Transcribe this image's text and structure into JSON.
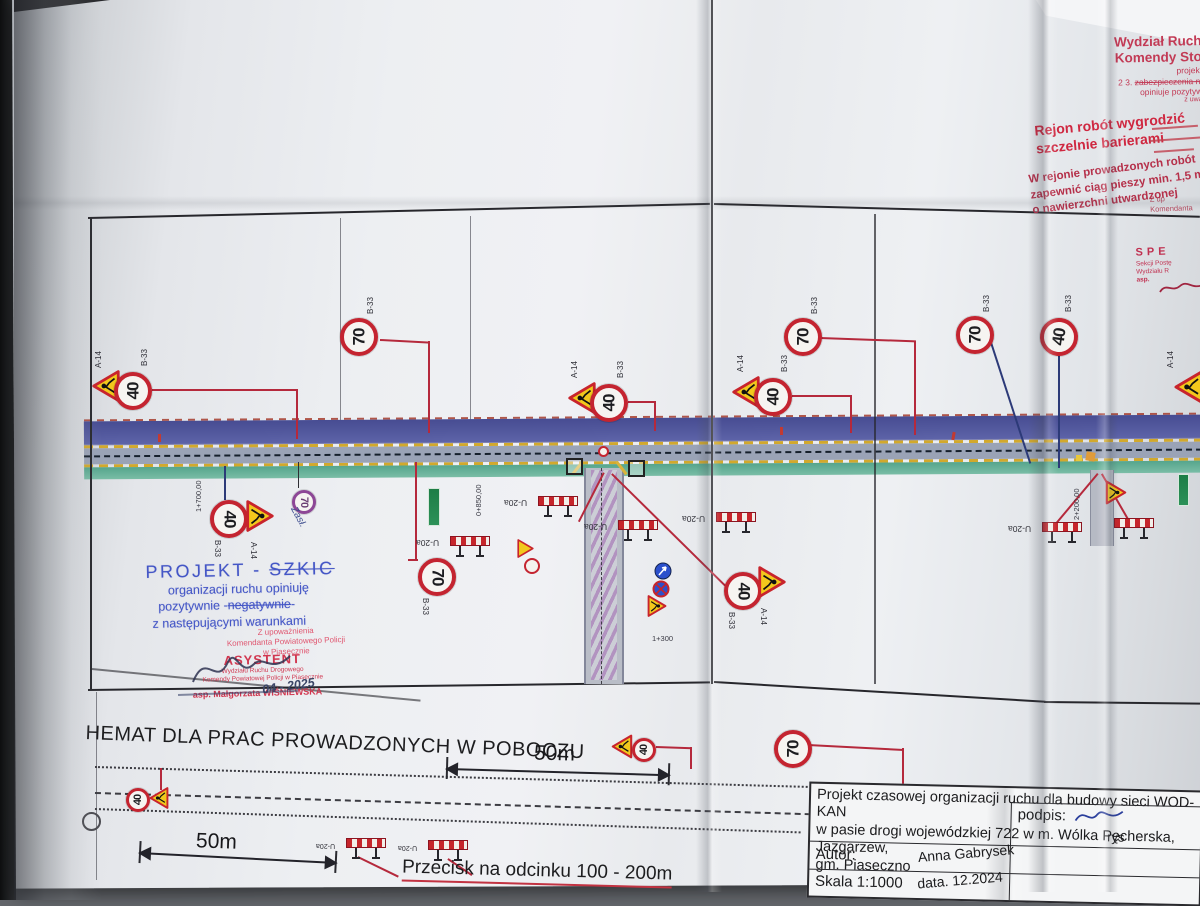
{
  "colors": {
    "paper": "#edeff2",
    "surface": "#63666b",
    "sign_red": "#c42430",
    "stamp_red": "#d1364f",
    "stamp_blue": "#4456c6",
    "road_blue": "#4d5296",
    "road_green": "#55a58c",
    "barrier_red": "#c6252b",
    "accent_yellow": "#f2c81c"
  },
  "plan": {
    "sign40": "40",
    "sign70": "70",
    "label_b33": "B-33",
    "label_a14": "A-14",
    "label_u20a": "U-20a",
    "hand_zasl": "Zasł.",
    "chainage_1": "1+700,00",
    "chainage_2": "0+850,00",
    "chainage_3": "2+200,00",
    "chainage_4": "1+300"
  },
  "stamps": {
    "wydzial": {
      "l1": "Wydział Ruch",
      "l2": "Komendy Sto",
      "l3": "projekt",
      "l4_prefix": "2 3. ",
      "l4_struck": "zabezpieczenia ni",
      "l5": "opiniuje pozytyw",
      "l6": "z uwa"
    },
    "fence_l1": "Rejon robót wygrodzić",
    "fence_l2": "szczelnie barierami",
    "walkway_l1": "W rejonie prowadzonych robót",
    "walkway_l2": "zapewnić ciąg pieszy min. 1,5 m",
    "walkway_l3": "o nawierzchni utwardzonej",
    "zup_l1": "Z up",
    "zup_l2": "Komendanta",
    "spe_l1": "SPE",
    "spe_l2": "Sekcji Postę",
    "spe_l3": "Wydziału R",
    "spe_l4": "asp.",
    "projekt": {
      "t1": "PROJEKT - ",
      "t1_struck": "SZKIC",
      "t2": "organizacji ruchu opiniuję",
      "t3a": "pozytywnie ",
      "t3b": "negatywnie",
      "t4": "z następującymi warunkami"
    },
    "upow_l1": "Z upoważnienia",
    "upow_l2": "Komendanta Powiatowego Policji",
    "upow_l3": "w Piasecznie",
    "asystent_l1": "ASYSTENT",
    "asystent_l2": "Wydziału Ruchu Drogowego",
    "asystent_l3": "Komendy Powiatowej Policji w Piasecznie",
    "officer": "asp. Małgorzata WIŚNIEWSKA",
    "hand_date": "04 - 2025"
  },
  "bottom": {
    "title": "HEMAT DLA PRAC PROWADZONYCH W POBOCZU",
    "dist_a": "50m",
    "dist_b": "50m",
    "note": "Przecisk na odcinku 100 - 200m"
  },
  "title_block": {
    "project_l1": "Projekt czasowej organizacji ruchu dla budowy sieci WOD-KAN",
    "project_l2": "w pasie drogi wojewódzkiej 722 w m. Wólka Pęcherska, Jazgarzew,",
    "project_l3": "gm. Piaseczno",
    "author_label": "Autor:",
    "author": "Anna Gabrysek",
    "scale": "Skala 1:1000",
    "date": "data. 12.2024",
    "signature_label": "podpis:",
    "rys_label": "rys"
  }
}
